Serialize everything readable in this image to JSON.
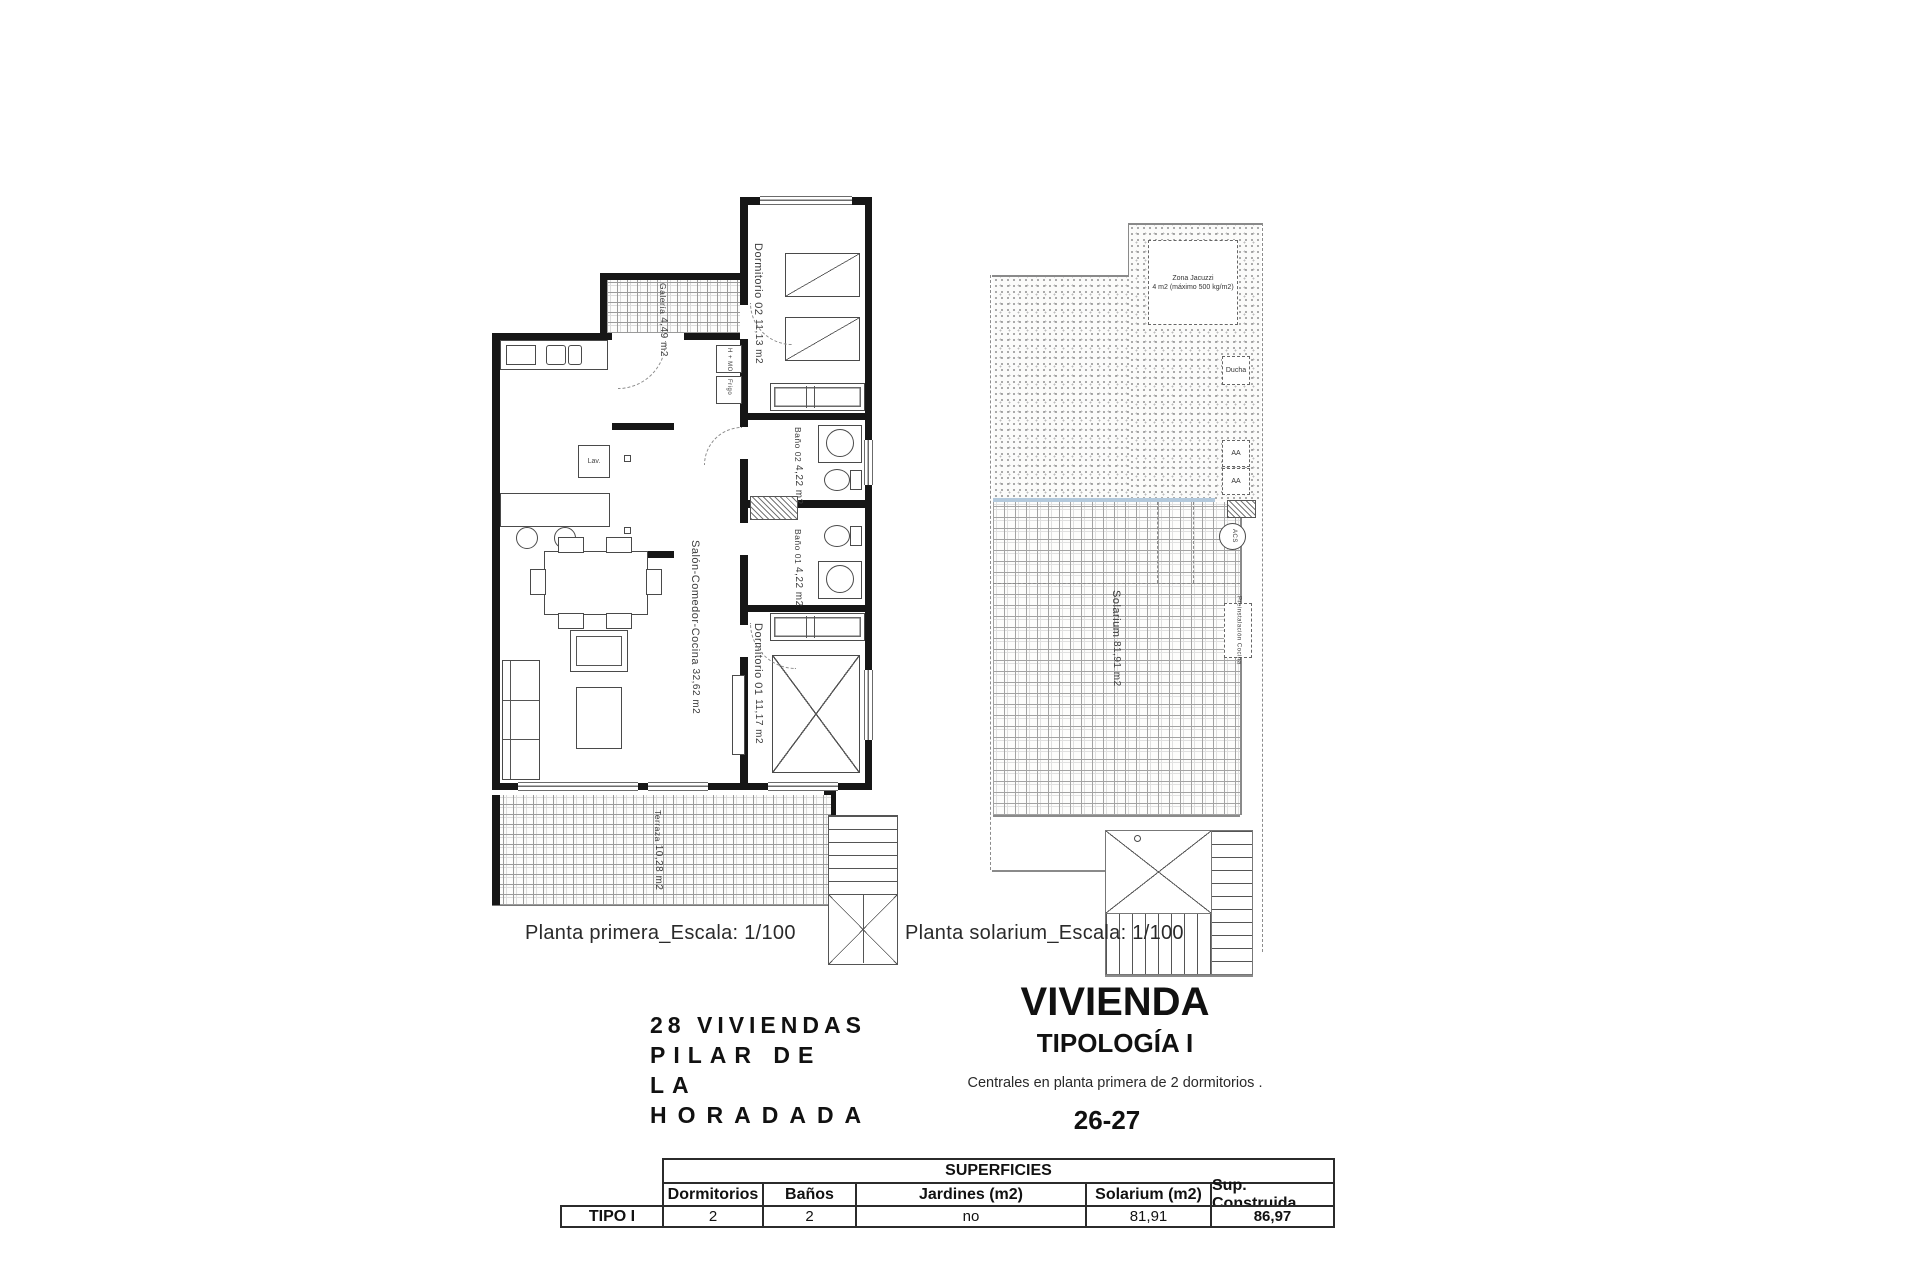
{
  "plans": {
    "first_floor": {
      "caption": "Planta primera_Escala: 1/100",
      "rooms": {
        "galeria": {
          "label": "Galería",
          "area": "4,49 m2"
        },
        "dormitorio02": {
          "label": "Dormitorio 02",
          "area": "11,13 m2"
        },
        "bano02": {
          "label": "Baño 02",
          "area": "4,22 m2"
        },
        "bano01": {
          "label": "Baño 01",
          "area": "4,22 m2"
        },
        "salon": {
          "label": "Salón-Comedor-Cocina",
          "area": "32,62 m2"
        },
        "dormitorio01": {
          "label": "Dormitorio 01",
          "area": "11,17 m2"
        },
        "terraza": {
          "label": "Terraza",
          "area": "10,28 m2"
        }
      },
      "fixtures": {
        "oven": "H + MO",
        "fridge": "Frigo",
        "washer": "Lav."
      }
    },
    "solarium": {
      "caption": "Planta solarium_Escala: 1/100",
      "labels": {
        "jacuzzi_line1": "Zona Jacuzzi",
        "jacuzzi_line2": "4 m2 (máximo 500 kg/m2)",
        "ducha": "Ducha",
        "aa": "AA",
        "acs": "ACS",
        "preinstalacion": "Preinstalación Cocina",
        "solarium": "Solarium",
        "solarium_area": "81,91 m2"
      }
    }
  },
  "title_block": {
    "project_line1": "28 VIVIENDAS",
    "project_line2": "PILAR DE LA",
    "project_line3": "HORADADA",
    "dwelling_title": "VIVIENDA",
    "typology": "TIPOLOGÍA I",
    "description": "Centrales en planta primera de 2 dormitorios .",
    "units": "26-27"
  },
  "table": {
    "title": "SUPERFICIES",
    "row_label": "TIPO I",
    "columns": [
      "Dormitorios",
      "Baños",
      "Jardines (m2)",
      "Solarium (m2)",
      "Sup. Construida"
    ],
    "values": [
      "2",
      "2",
      "no",
      "81,91",
      "86,97"
    ]
  }
}
